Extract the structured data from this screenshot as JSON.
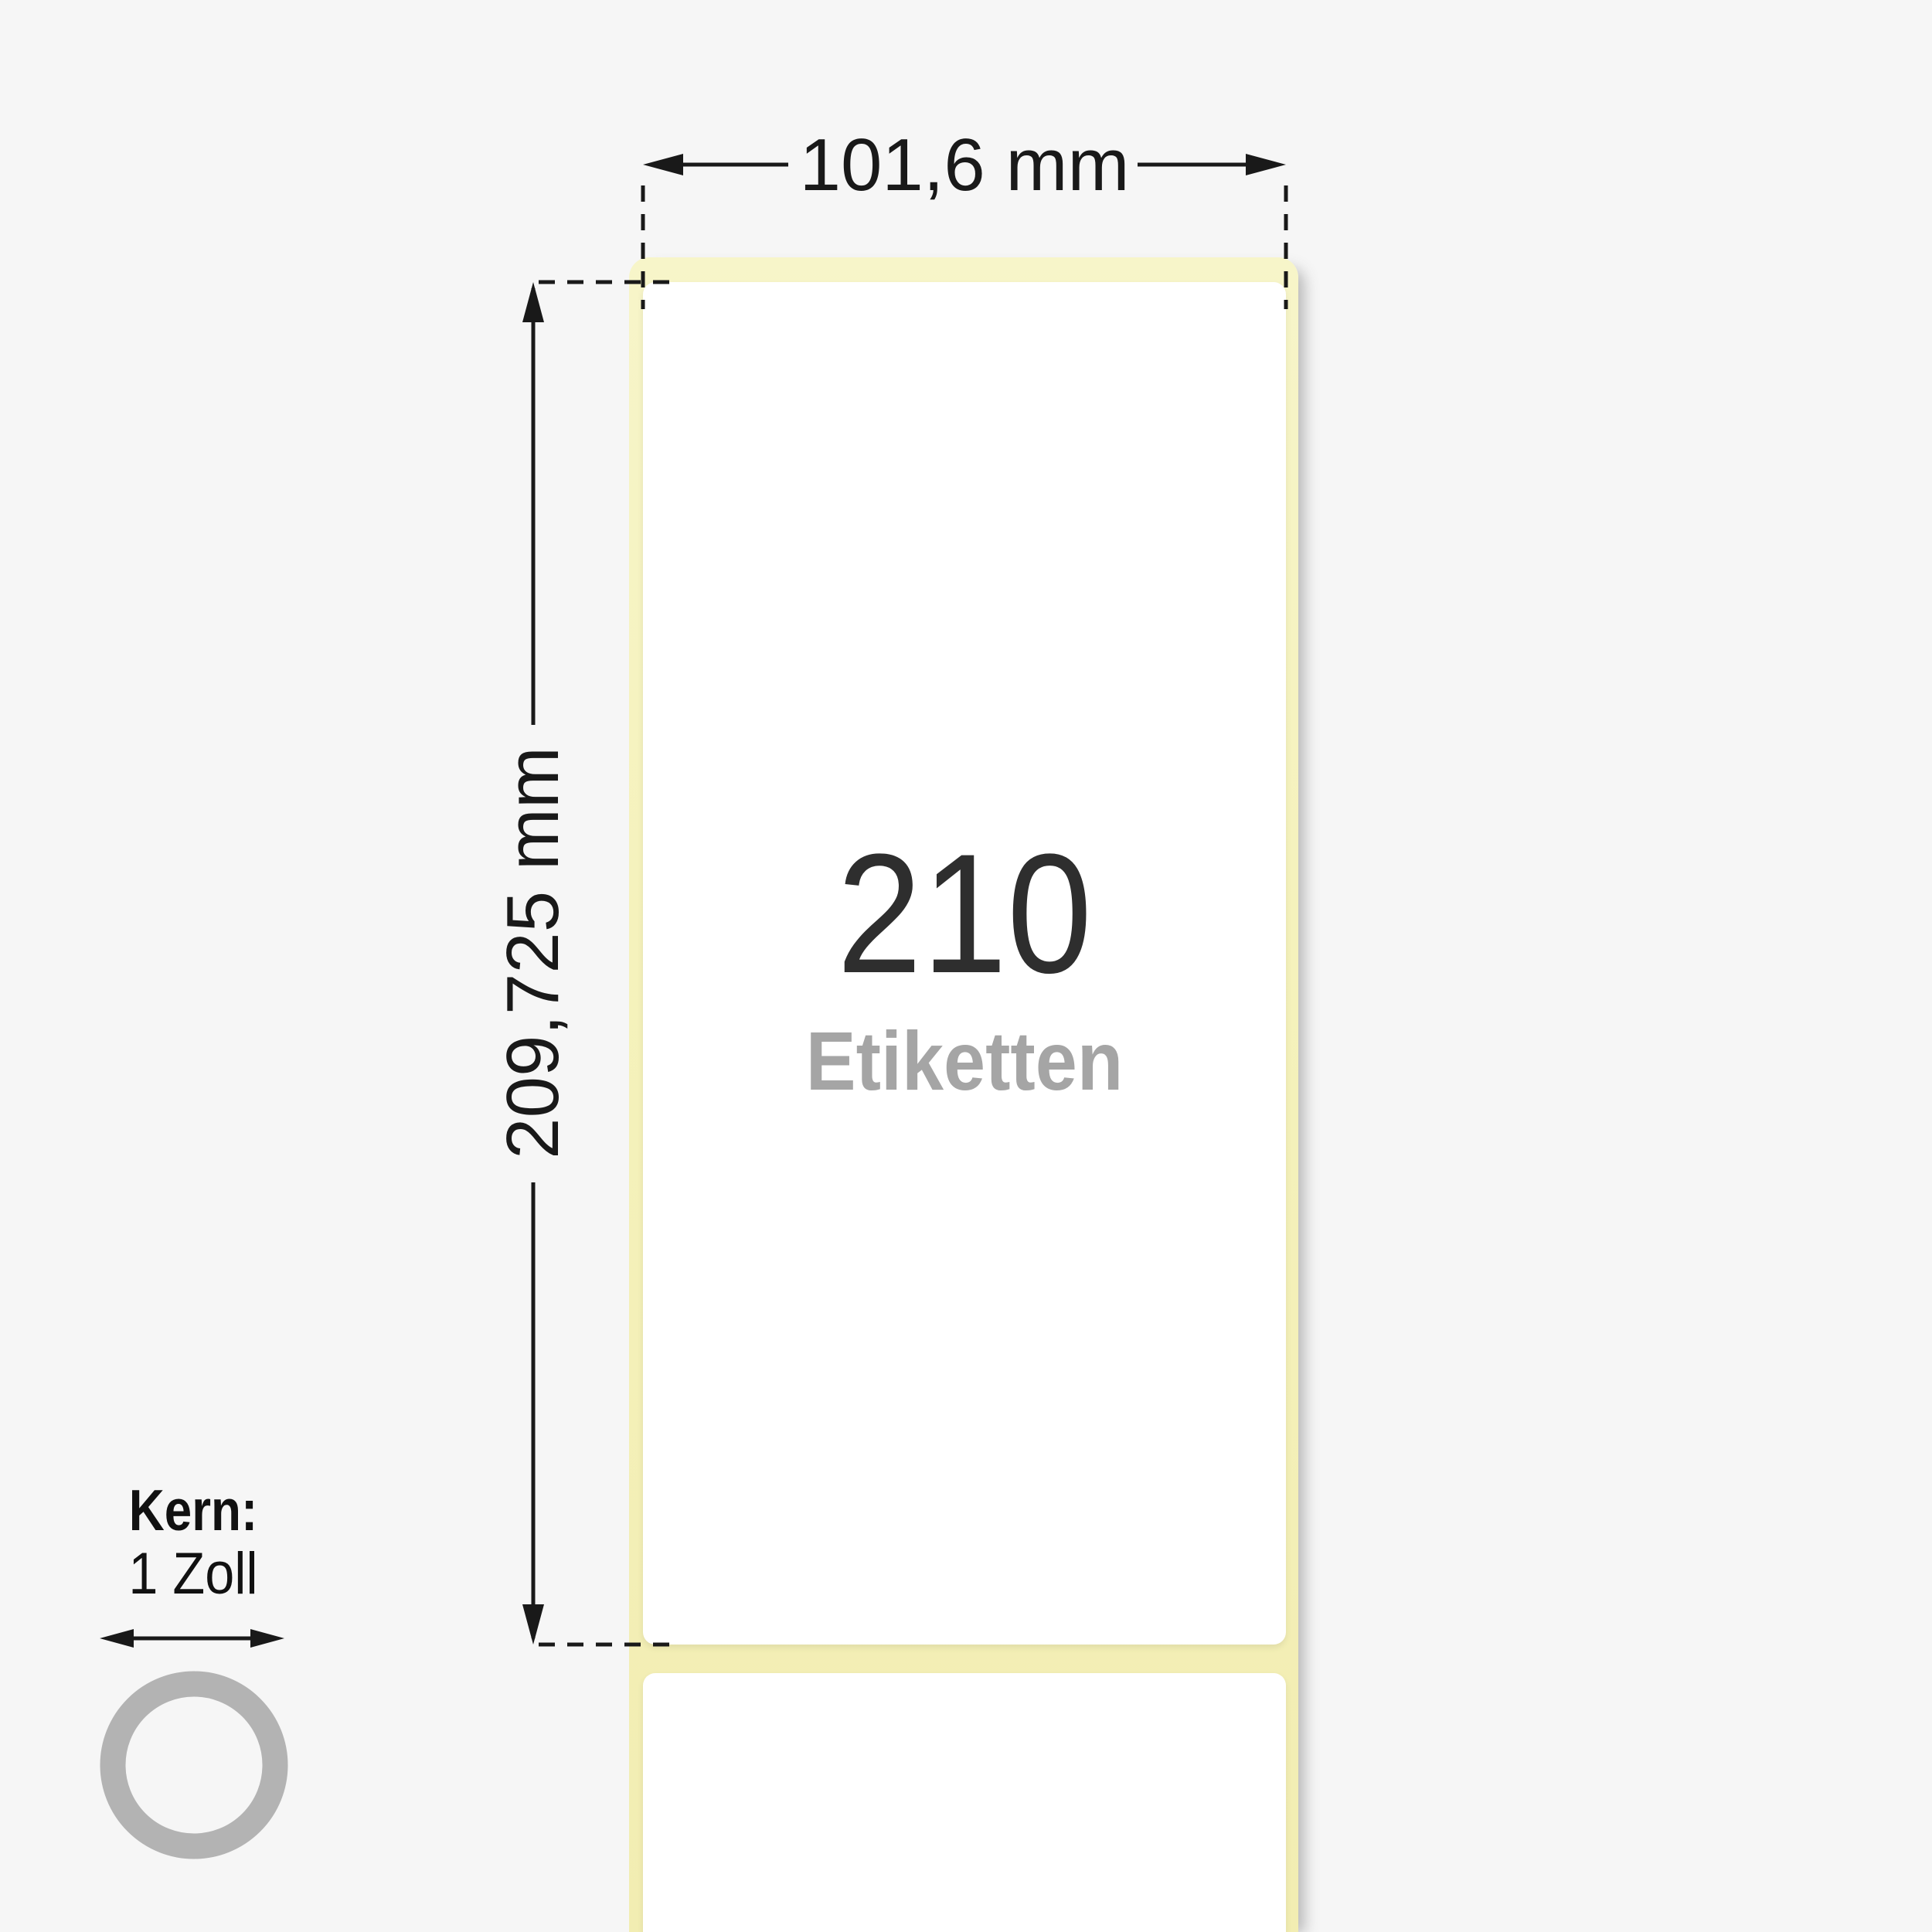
{
  "dimensions": {
    "width": "101,6 mm",
    "height": "209,725 mm"
  },
  "roll": {
    "count": "210",
    "unit": "Etiketten"
  },
  "core": {
    "label": "Kern:",
    "value": "1 Zoll"
  },
  "colors": {
    "background": "#f6f6f6",
    "liner": "#f5f2bc",
    "label": "#ffffff",
    "dimension_lines": "#191919",
    "count_text": "#2e2e2e",
    "unit_text": "#a5a5a5",
    "core_ring": "#b3b3b3"
  },
  "icons": {
    "width_dimension_arrows": "left-right-arrow",
    "height_dimension_arrows": "up-down-arrow",
    "core_diameter_arrow": "left-right-arrow",
    "core_ring": "ring-circle"
  }
}
